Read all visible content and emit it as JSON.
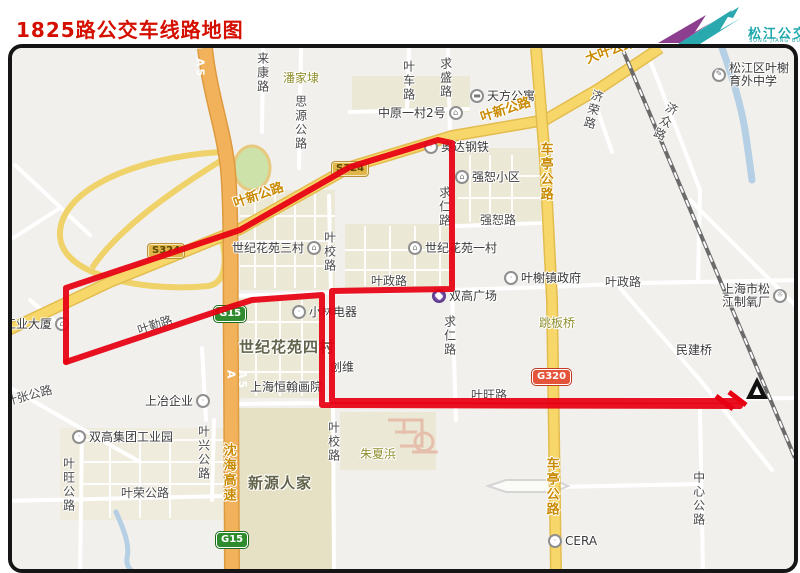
{
  "header": {
    "title": "1825路公交车线路地图",
    "logo": {
      "cn": "松江公交",
      "en": "SONG JIANG BUS",
      "teal": "#1fa8ac",
      "purple": "#8c3f8f"
    }
  },
  "icon_glyphs": {
    "building": "⌂",
    "gear": "☼",
    "dot": "·",
    "bed": "▬",
    "school": "✎",
    "mall": "◆"
  },
  "map": {
    "badges": [
      {
        "text": "S324",
        "x": 147,
        "y": 243,
        "type": "s"
      },
      {
        "text": "S324",
        "x": 331,
        "y": 161,
        "type": "s"
      },
      {
        "text": "G15",
        "x": 214,
        "y": 306,
        "type": "g"
      },
      {
        "text": "G15",
        "x": 216,
        "y": 532,
        "type": "g"
      },
      {
        "text": "G320",
        "x": 532,
        "y": 369,
        "type": "n"
      }
    ],
    "labels": [
      {
        "text": "来康路",
        "x": 256,
        "y": 52,
        "style": "road",
        "dir": "v"
      },
      {
        "text": "潘家埭",
        "x": 283,
        "y": 72,
        "style": "olive"
      },
      {
        "text": "思源公路",
        "x": 294,
        "y": 95,
        "style": "road",
        "dir": "v"
      },
      {
        "text": "中原一村2号",
        "x": 378,
        "y": 106,
        "style": "place",
        "icon": "building",
        "iconSide": "right"
      },
      {
        "text": "天方公寓",
        "x": 470,
        "y": 89,
        "style": "place",
        "icon": "bed",
        "iconSide": "left"
      },
      {
        "text": "叶车路",
        "x": 402,
        "y": 60,
        "style": "road",
        "dir": "v"
      },
      {
        "text": "求盛路",
        "x": 439,
        "y": 57,
        "style": "road",
        "dir": "v"
      },
      {
        "text": "叶新公路",
        "x": 232,
        "y": 198,
        "style": "roadmajor",
        "rot": -19
      },
      {
        "text": "叶新公路",
        "x": 479,
        "y": 112,
        "style": "roadmajor",
        "rot": -18
      },
      {
        "text": "大叶公路",
        "x": 584,
        "y": 54,
        "style": "roadmajor",
        "rot": -20
      },
      {
        "text": "济荣路",
        "x": 592,
        "y": 88,
        "style": "road",
        "dir": "v",
        "rot": 15
      },
      {
        "text": "松江区叶榭\n育外中学",
        "x": 712,
        "y": 62,
        "style": "place",
        "icon": "school",
        "iconSide": "left"
      },
      {
        "text": "济众路",
        "x": 668,
        "y": 100,
        "style": "road",
        "dir": "v",
        "rot": 25
      },
      {
        "text": "奥达钢铁",
        "x": 424,
        "y": 140,
        "style": "place",
        "icon": "dot",
        "iconSide": "left"
      },
      {
        "text": "强恕小区",
        "x": 455,
        "y": 170,
        "style": "place",
        "icon": "building",
        "iconSide": "left"
      },
      {
        "text": "强恕路",
        "x": 480,
        "y": 214,
        "style": "road"
      },
      {
        "text": "世纪花苑三村",
        "x": 232,
        "y": 241,
        "style": "place",
        "icon": "building",
        "iconSide": "right"
      },
      {
        "text": "世纪花苑一村",
        "x": 408,
        "y": 241,
        "style": "place",
        "icon": "building",
        "iconSide": "left"
      },
      {
        "text": "叶校路",
        "x": 323,
        "y": 231,
        "style": "road",
        "dir": "v"
      },
      {
        "text": "求仁路",
        "x": 438,
        "y": 186,
        "style": "road",
        "dir": "v"
      },
      {
        "text": "车亭公路",
        "x": 538,
        "y": 142,
        "style": "roadmajor",
        "dir": "v"
      },
      {
        "text": "叶政路",
        "x": 371,
        "y": 275,
        "style": "road"
      },
      {
        "text": "叶政路",
        "x": 605,
        "y": 276,
        "style": "road"
      },
      {
        "text": "叶榭镇政府",
        "x": 504,
        "y": 271,
        "style": "place",
        "icon": "dot",
        "iconSide": "left"
      },
      {
        "text": "上海市松\n江制氧厂",
        "x": 722,
        "y": 283,
        "style": "place",
        "icon": "gear",
        "iconSide": "right"
      },
      {
        "text": "双高广场",
        "x": 432,
        "y": 289,
        "style": "place",
        "icon": "mall",
        "iconSide": "left"
      },
      {
        "text": "跳板桥",
        "x": 539,
        "y": 317,
        "style": "olive"
      },
      {
        "text": "民建桥",
        "x": 676,
        "y": 344,
        "style": "place"
      },
      {
        "text": "工业大厦",
        "x": 4,
        "y": 317,
        "style": "place",
        "icon": "building",
        "iconSide": "right"
      },
      {
        "text": "叶勤路",
        "x": 136,
        "y": 325,
        "style": "road",
        "rot": -18
      },
      {
        "text": "小林电器",
        "x": 292,
        "y": 305,
        "style": "place",
        "icon": "dot",
        "iconSide": "left"
      },
      {
        "text": "世纪花苑四村",
        "x": 239,
        "y": 340,
        "style": "placebold"
      },
      {
        "text": "求仁路",
        "x": 443,
        "y": 315,
        "style": "road",
        "dir": "v"
      },
      {
        "text": "创维",
        "x": 330,
        "y": 361,
        "style": "place"
      },
      {
        "text": "上海恒翰画院",
        "x": 250,
        "y": 381,
        "style": "place"
      },
      {
        "text": "叶张公路",
        "x": 4,
        "y": 396,
        "style": "road",
        "rot": -15
      },
      {
        "text": "上冶企业",
        "x": 145,
        "y": 394,
        "style": "place",
        "icon": "dot",
        "iconSide": "right"
      },
      {
        "text": "A5",
        "x": 194,
        "y": 58,
        "style": "hwy",
        "dir": "v"
      },
      {
        "text": "A5\nA",
        "x": 225,
        "y": 370,
        "style": "hwy",
        "dir": "v"
      },
      {
        "text": "沈海高速",
        "x": 221,
        "y": 443,
        "style": "roadmajor",
        "dir": "v"
      },
      {
        "text": "双高集团工业园",
        "x": 72,
        "y": 430,
        "style": "place",
        "icon": "dot",
        "iconSide": "left"
      },
      {
        "text": "叶兴公路",
        "x": 197,
        "y": 425,
        "style": "road",
        "dir": "v"
      },
      {
        "text": "叶旺公路",
        "x": 62,
        "y": 457,
        "style": "road",
        "dir": "v"
      },
      {
        "text": "叶荣公路",
        "x": 121,
        "y": 487,
        "style": "road"
      },
      {
        "text": "新源人家",
        "x": 248,
        "y": 476,
        "style": "placebold"
      },
      {
        "text": "叶校路",
        "x": 327,
        "y": 421,
        "style": "road",
        "dir": "v"
      },
      {
        "text": "朱夏浜",
        "x": 360,
        "y": 448,
        "style": "olive"
      },
      {
        "text": "叶旺路",
        "x": 471,
        "y": 389,
        "style": "road"
      },
      {
        "text": "车亭公路",
        "x": 544,
        "y": 457,
        "style": "roadmajor",
        "dir": "v"
      },
      {
        "text": "中心公路",
        "x": 692,
        "y": 471,
        "style": "road",
        "dir": "v"
      },
      {
        "text": "CERA",
        "x": 548,
        "y": 534,
        "style": "place",
        "icon": "dot",
        "iconSide": "left"
      }
    ],
    "route": {
      "name": "1825路",
      "color": "#e60012",
      "width": 6,
      "path_out": [
        [
          66,
          362
        ],
        [
          66,
          288
        ],
        [
          240,
          230
        ],
        [
          350,
          167
        ],
        [
          438,
          140
        ],
        [
          452,
          143
        ],
        [
          452,
          289
        ],
        [
          332,
          291
        ],
        [
          332,
          401
        ],
        [
          740,
          401
        ]
      ],
      "path_back": [
        [
          740,
          406
        ],
        [
          322,
          405
        ],
        [
          322,
          295
        ],
        [
          252,
          300
        ],
        [
          230,
          307
        ],
        [
          66,
          362
        ]
      ],
      "hatches": [
        [
          716,
          396,
          733,
          409
        ],
        [
          729,
          392,
          746,
          405
        ]
      ],
      "terminus": {
        "x": 757,
        "y": 390
      }
    }
  }
}
